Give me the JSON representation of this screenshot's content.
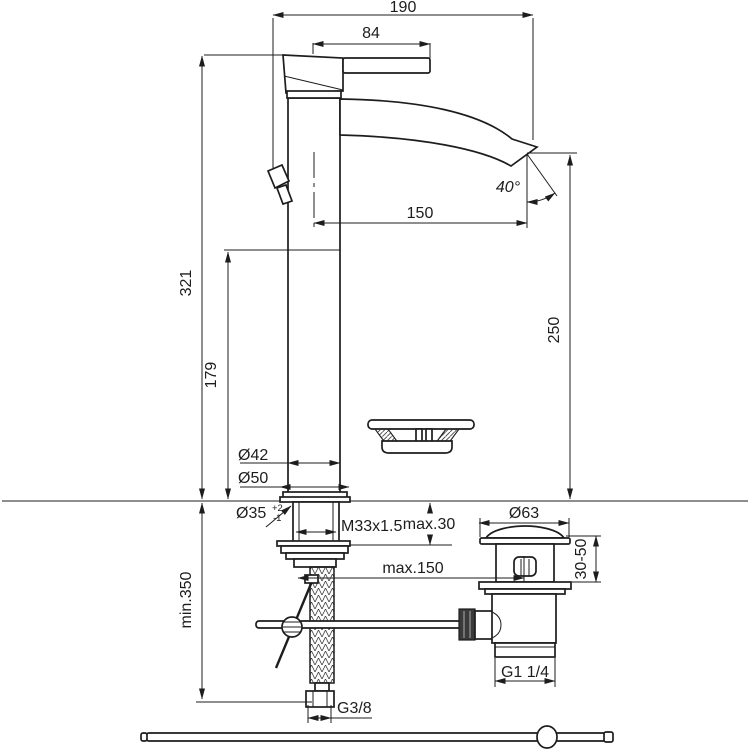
{
  "drawing": {
    "kind": "technical-dimension-drawing",
    "subject": "single-lever high basin mixer with pop-up waste, supply hose and pull rod",
    "line_color": "#1d1d1d",
    "background_color": "#ffffff"
  },
  "dimensions": {
    "overall_width": "190",
    "lever_length": "84",
    "spout_reach": "150",
    "spout_angle": "40°",
    "overall_height": "321",
    "body_height": "179",
    "outlet_height": "250",
    "body_diameter": "Ø42",
    "base_diameter": "Ø50",
    "hole_diameter": "Ø35",
    "hole_tolerance_plus": "+2",
    "hole_tolerance_minus": "-1",
    "shank_thread": "M33x1.5",
    "max_deck_thickness": "max.30",
    "waste_flange_diameter": "Ø63",
    "basin_thickness_range": "30-50",
    "max_rod_distance": "max.150",
    "min_hose_length": "min.350",
    "waste_outlet_thread": "G1 1/4",
    "hose_thread": "G3/8"
  }
}
